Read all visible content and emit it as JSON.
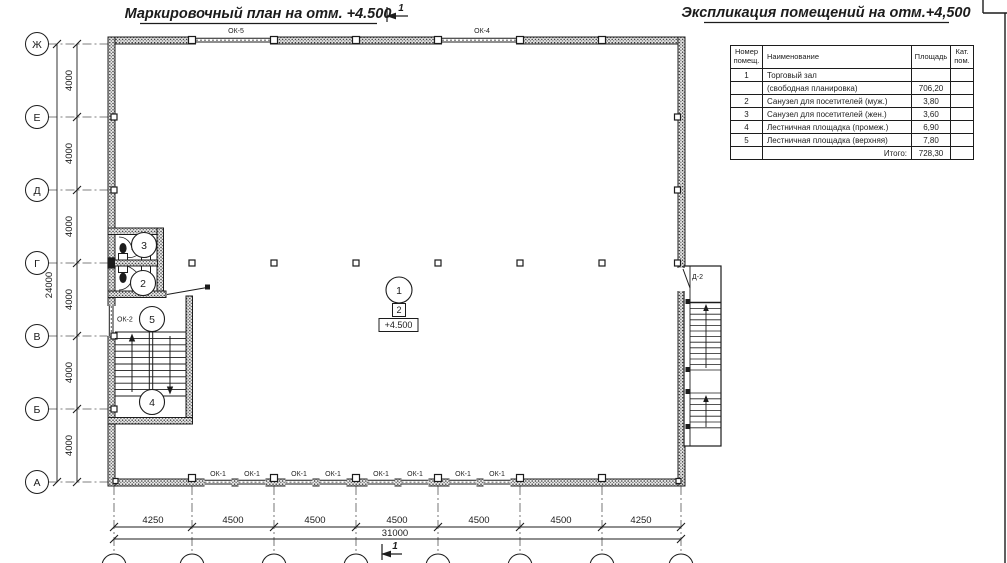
{
  "titles": {
    "plan": "Маркировочный план на отм. +4.500",
    "schedule": "Экспликация помещений на отм.+4,500"
  },
  "section_mark": {
    "label": "1"
  },
  "axes": {
    "rows": [
      "Ж",
      "Е",
      "Д",
      "Г",
      "В",
      "Б",
      "А"
    ],
    "cols": [
      "1",
      "2",
      "3",
      "4",
      "5",
      "6",
      "7",
      "8"
    ]
  },
  "dims": {
    "left_segments": [
      "4000",
      "4000",
      "4000",
      "4000",
      "4000",
      "4000"
    ],
    "left_total": "24000",
    "bottom_segments": [
      "4250",
      "4500",
      "4500",
      "4500",
      "4500",
      "4500",
      "4250"
    ],
    "bottom_total": "31000"
  },
  "marks": {
    "ok1": "ОК-1",
    "ok2": "ОК-2",
    "ok4": "ОК-4",
    "ok5": "ОК-5",
    "d2": "Д-2",
    "level": "+4.500",
    "zone": "2"
  },
  "rooms": {
    "labels": [
      "1",
      "2",
      "3",
      "4",
      "5"
    ]
  },
  "schedule": {
    "headers": {
      "num": "Номер\nпомещ.",
      "name": "Наименование",
      "area": "Площадь",
      "cat": "Кат.\nпом."
    },
    "rows": [
      {
        "num": "1",
        "name": "Торговый зал",
        "area": "",
        "cat": ""
      },
      {
        "num": "",
        "name": "(свободная планировка)",
        "area": "706,20",
        "cat": ""
      },
      {
        "num": "2",
        "name": "Санузел для посетителей (муж.)",
        "area": "3,80",
        "cat": ""
      },
      {
        "num": "3",
        "name": "Санузел для посетителей (жен.)",
        "area": "3,60",
        "cat": ""
      },
      {
        "num": "4",
        "name": "Лестничная площадка (промеж.)",
        "area": "6,90",
        "cat": ""
      },
      {
        "num": "5",
        "name": "Лестничная площадка (верхняя)",
        "area": "7,80",
        "cat": ""
      }
    ],
    "total_label": "Итого:",
    "total_value": "728,30"
  },
  "colors": {
    "ink": "#1c1c1c",
    "paper": "#ffffff"
  }
}
